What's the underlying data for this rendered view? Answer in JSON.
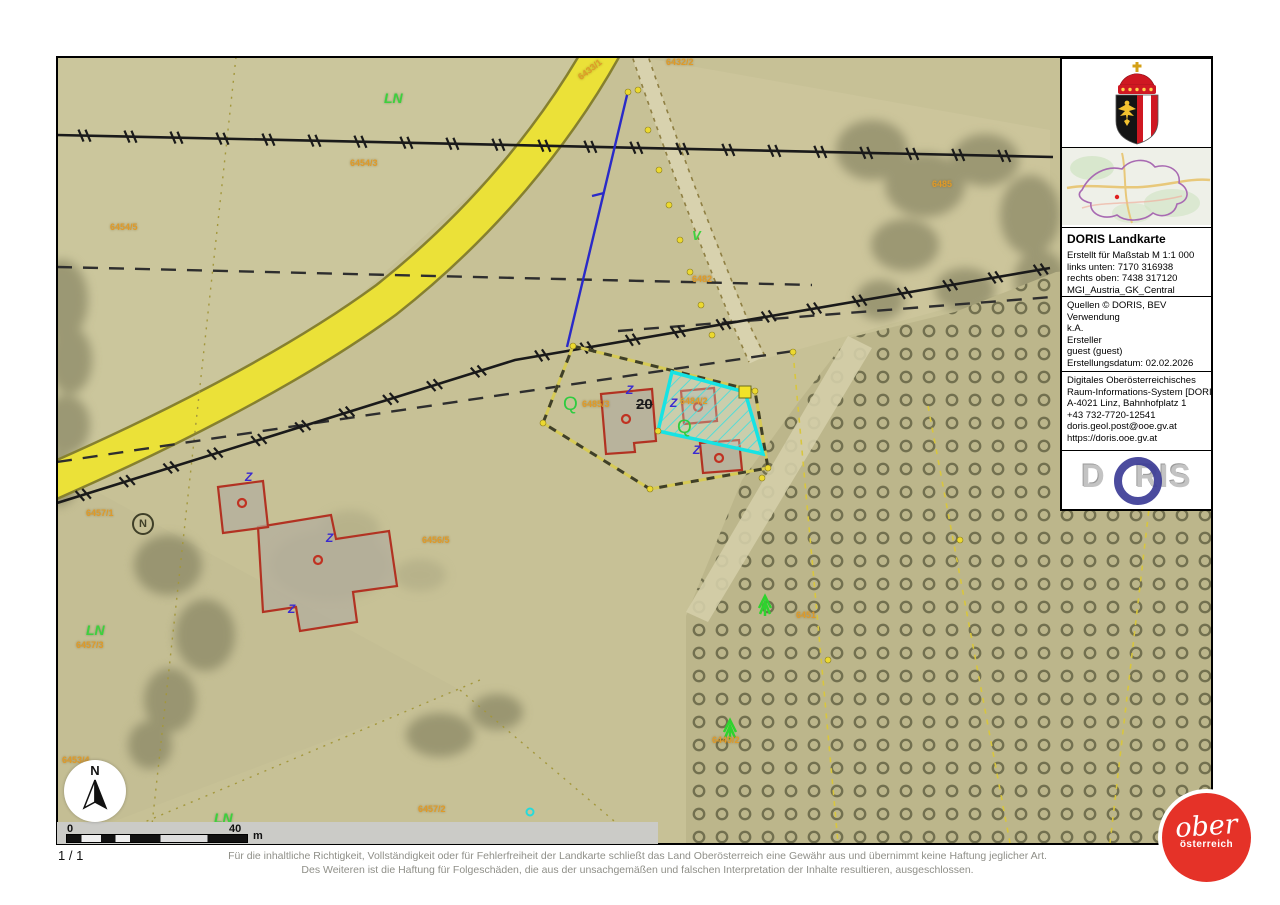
{
  "panel": {
    "title": "DORIS Landkarte",
    "meta_lines": [
      "Erstellt für Maßstab M 1:1 000",
      "links unten: 7170 316938",
      "rechts oben: 7438 317120",
      "MGI_Austria_GK_Central"
    ],
    "source_lines": [
      "Quellen © DORIS, BEV",
      "Verwendung",
      "k.A.",
      "Ersteller",
      "guest (guest)",
      "Erstellungsdatum: 02.02.2026"
    ],
    "contact_lines": [
      "Digitales Oberösterreichisches",
      "Raum-Informations-System [DORIS]",
      "A-4021 Linz, Bahnhofplatz 1",
      "+43 732-7720-12541",
      "doris.geol.post@ooe.gv.at",
      "https://doris.ooe.gv.at"
    ],
    "doris_logo": {
      "left": "D",
      "right": "RIS"
    }
  },
  "footer": {
    "page_indicator": "1 / 1",
    "disclaimer_line1": "Für die inhaltliche Richtigkeit, Vollständigkeit oder für Fehlerfreiheit der Landkarte schließt das Land Oberösterreich eine Gewähr aus und übernimmt keine Haftung jeglicher Art.",
    "disclaimer_line2": "Des Weiteren ist die Haftung für Folgeschäden, die aus der unsachgemäßen und falschen Interpretation der Inhalte resultieren, ausgeschlossen."
  },
  "scalebar": {
    "start": "0",
    "end": "40",
    "unit": "m"
  },
  "north_arrow": {
    "label": "N"
  },
  "ober_logo": {
    "line1": "ober",
    "line2": "österreich"
  },
  "map": {
    "labels": [
      {
        "text": "LN",
        "x": 384,
        "y": 90,
        "cls": "lbl-ln"
      },
      {
        "text": "6433/1",
        "x": 576,
        "y": 74,
        "cls": "lbl-orange",
        "rot": -38
      },
      {
        "text": "6432/2",
        "x": 666,
        "y": 57,
        "cls": "lbl-orange"
      },
      {
        "text": "6454/3",
        "x": 350,
        "y": 158,
        "cls": "lbl-orange"
      },
      {
        "text": "6485",
        "x": 932,
        "y": 179,
        "cls": "lbl-orange"
      },
      {
        "text": "6454/5",
        "x": 110,
        "y": 222,
        "cls": "lbl-orange"
      },
      {
        "text": "V",
        "x": 692,
        "y": 228,
        "cls": "lbl-green-sym"
      },
      {
        "text": "6482",
        "x": 692,
        "y": 274,
        "cls": "lbl-orange"
      },
      {
        "text": "Q",
        "x": 563,
        "y": 394,
        "cls": "lbl-q"
      },
      {
        "text": "6485/3",
        "x": 582,
        "y": 399,
        "cls": "lbl-orange"
      },
      {
        "text": "20",
        "x": 636,
        "y": 396,
        "cls": "lbl-house"
      },
      {
        "text": "6484/2",
        "x": 680,
        "y": 396,
        "cls": "lbl-orange"
      },
      {
        "text": "Q",
        "x": 677,
        "y": 417,
        "cls": "lbl-q"
      },
      {
        "text": "6456/5",
        "x": 422,
        "y": 535,
        "cls": "lbl-orange"
      },
      {
        "text": "6457/1",
        "x": 86,
        "y": 508,
        "cls": "lbl-orange"
      },
      {
        "text": "N",
        "x": 132,
        "y": 513,
        "cls": "lbl-circled-n"
      },
      {
        "text": "LN",
        "x": 86,
        "y": 622,
        "cls": "lbl-ln"
      },
      {
        "text": "6457/3",
        "x": 76,
        "y": 640,
        "cls": "lbl-orange"
      },
      {
        "text": "6451",
        "x": 796,
        "y": 610,
        "cls": "lbl-orange"
      },
      {
        "text": "6449/2",
        "x": 712,
        "y": 735,
        "cls": "lbl-orange"
      },
      {
        "text": "6453/4",
        "x": 62,
        "y": 755,
        "cls": "lbl-orange"
      },
      {
        "text": "LN",
        "x": 214,
        "y": 810,
        "cls": "lbl-ln"
      },
      {
        "text": "6457/2",
        "x": 418,
        "y": 804,
        "cls": "lbl-orange"
      },
      {
        "text": "Z",
        "x": 626,
        "y": 383,
        "cls": "lbl-z"
      },
      {
        "text": "Z",
        "x": 670,
        "y": 396,
        "cls": "lbl-z"
      },
      {
        "text": "Z",
        "x": 693,
        "y": 443,
        "cls": "lbl-z"
      },
      {
        "text": "Z",
        "x": 326,
        "y": 531,
        "cls": "lbl-z"
      },
      {
        "text": "Z",
        "x": 288,
        "y": 602,
        "cls": "lbl-z"
      },
      {
        "text": "Z",
        "x": 245,
        "y": 470,
        "cls": "lbl-z"
      }
    ]
  },
  "colors": {
    "selection_cyan": "#17e3e3",
    "road_yellow": "#ebe138",
    "parcel_label_orange": "#e09a28",
    "land_use_green": "#3dd13d",
    "logo_red": "#e53228",
    "doris_ring_blue": "#3c3c96"
  }
}
